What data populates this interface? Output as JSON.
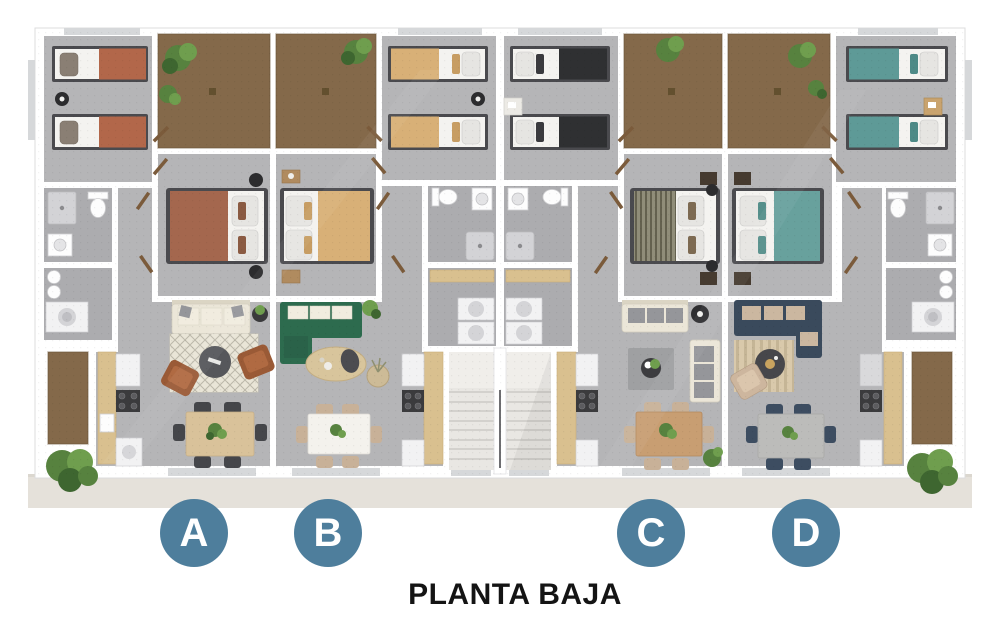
{
  "title": "PLANTA BAJA",
  "units": [
    {
      "label": "A",
      "accent": "#b2674a"
    },
    {
      "label": "B",
      "accent": "#d8b077"
    },
    {
      "label": "C",
      "accent": "#2f3032"
    },
    {
      "label": "D",
      "accent": "#5e9a97"
    }
  ],
  "palette": {
    "badge": "#4e7e9c",
    "title": "#141414",
    "floor": "#b5b5b7",
    "floor-dark": "#acacaf",
    "patio": "#84694a",
    "base-strip": "#e5e1da",
    "wall": "#ffffff",
    "brown-bed": "#a4674e",
    "green-sofa": "#2d6b4e",
    "navy-sofa": "#3a4a5c",
    "cream-sofa": "#ebe6d8",
    "wood": "#d9c29a"
  }
}
